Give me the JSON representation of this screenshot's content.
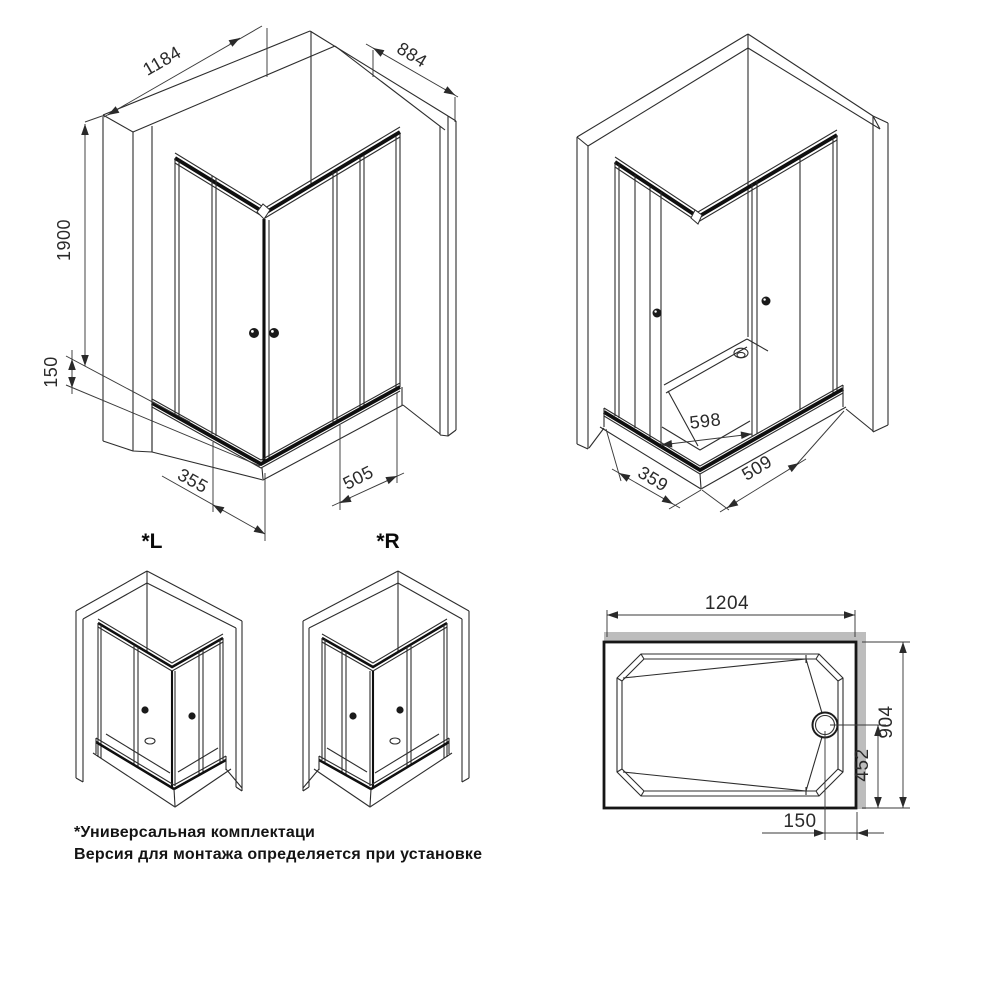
{
  "palette": {
    "background": "#ffffff",
    "line": "#2d2d2d",
    "profile_dark": "#0f0f0f",
    "wall_gray": "#bdbdbd",
    "dim_text": "#2a2a2a"
  },
  "views": {
    "iso_front": {
      "description": "isometric corner view, doors closed",
      "dims": {
        "width": "1184",
        "depth": "884",
        "height": "1900",
        "tray_height": "150",
        "left_door": "355",
        "right_door": "505"
      }
    },
    "iso_open": {
      "description": "isometric corner view, doors open",
      "dims": {
        "entry_opening": "598",
        "left_door": "359",
        "right_door": "509"
      }
    },
    "orientation": {
      "left_label": "*L",
      "right_label": "*R"
    },
    "tray_plan": {
      "description": "shower tray plan view",
      "dims": {
        "length": "1204",
        "width": "904",
        "drain_from_bottom": "452",
        "drain_from_right": "150"
      }
    }
  },
  "footnote": {
    "line1": "*Универсальная комплектаци",
    "line2": "Версия для монтажа определяется при установке"
  }
}
